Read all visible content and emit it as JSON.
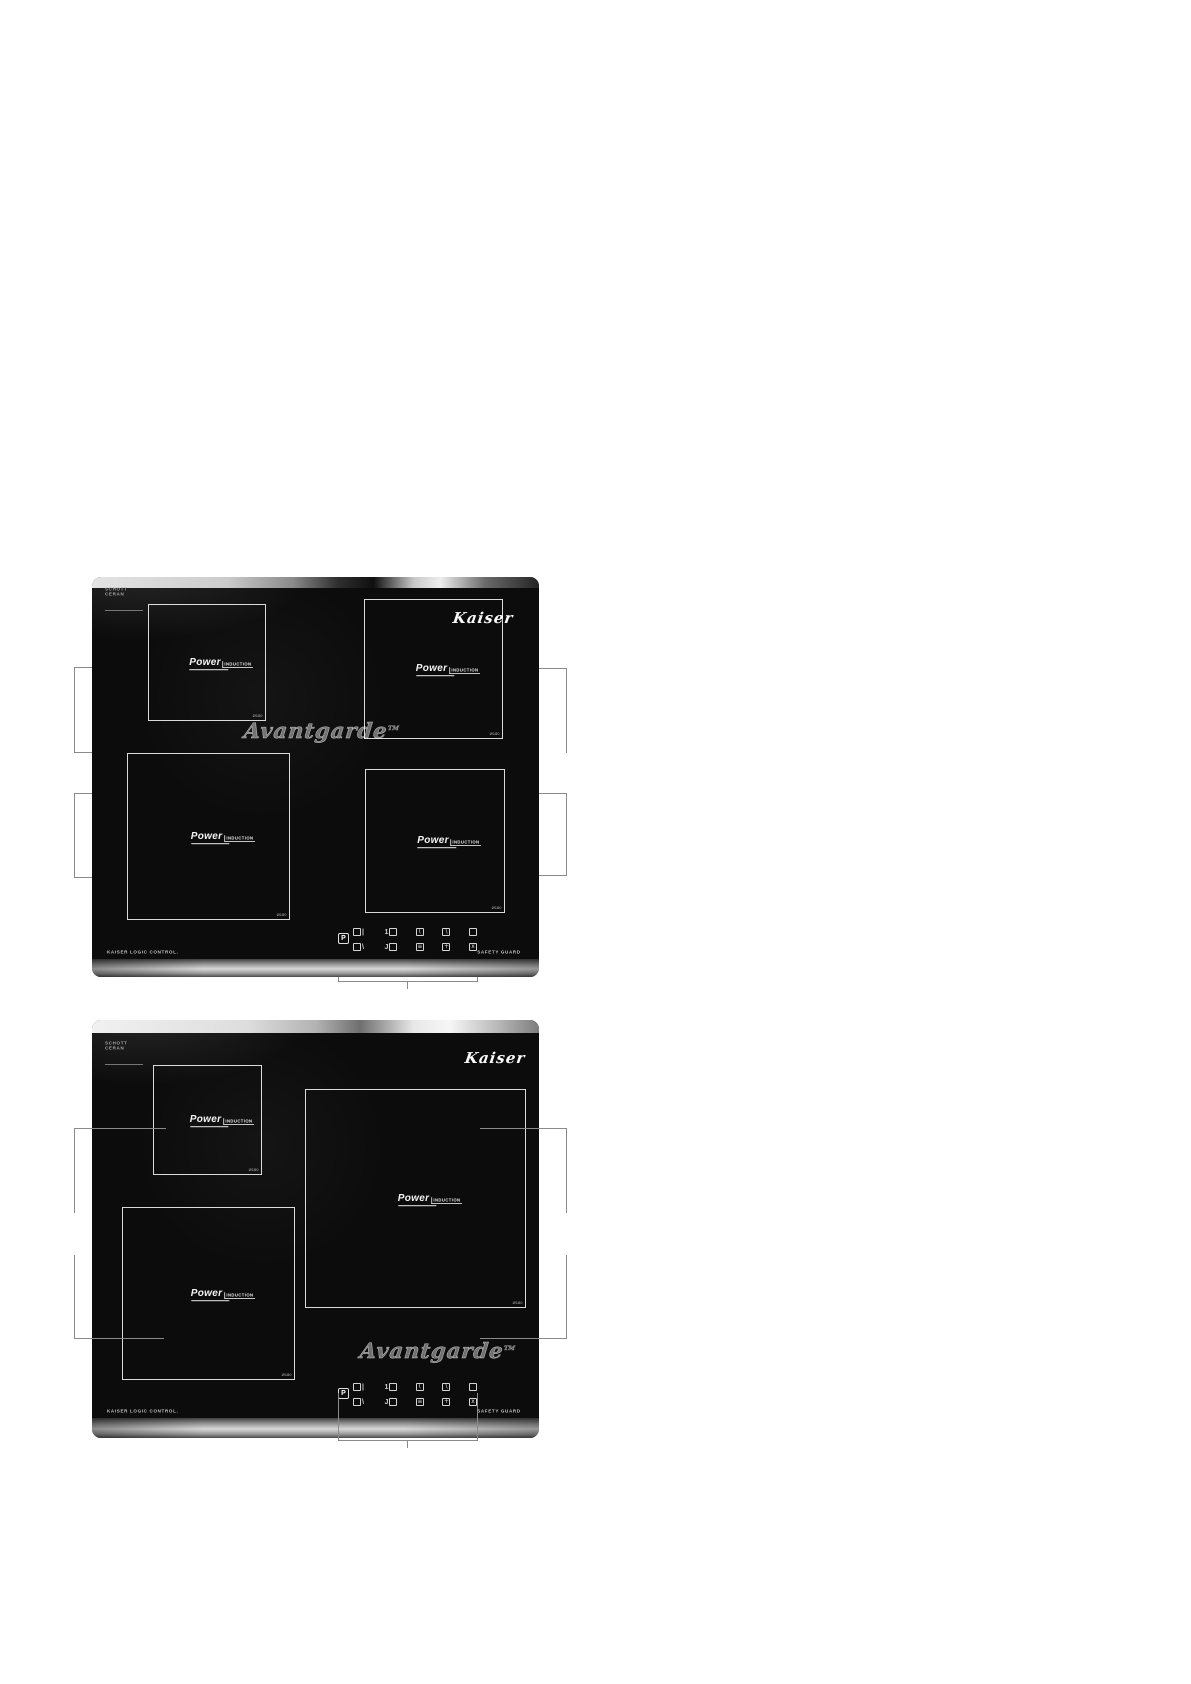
{
  "document": {
    "type": "appliance manual illustration page",
    "background": "#ffffff"
  },
  "shared": {
    "brand_logo": "Kaiser",
    "series_logo": "Avantgarde",
    "series_tm": "TM",
    "glass_mark": {
      "line1": "SCHOTT",
      "line2": "CERAN"
    },
    "power_logo": {
      "line1": "Power",
      "line2": "INDUCTION"
    },
    "bottom_left_label": "KAISER LOGIC CONTROL.",
    "bottom_right_label": "SAFETY GUARD",
    "controls": {
      "power_key": "P",
      "row1": [
        {
          "pre": "",
          "in": "",
          "suf": "|"
        },
        {
          "pre": "1",
          "in": "",
          "suf": ""
        },
        {
          "pre": "",
          "in": "(",
          "suf": ""
        },
        {
          "pre": "",
          "in": "\\",
          "suf": ""
        },
        {
          "pre": "",
          "in": "",
          "suf": ""
        }
      ],
      "row2": [
        {
          "pre": "",
          "in": "",
          "suf": "\\"
        },
        {
          "pre": "J",
          "in": "",
          "suf": ""
        },
        {
          "pre": "",
          "in": "≡",
          "suf": ""
        },
        {
          "pre": "",
          "in": "+",
          "suf": ""
        },
        {
          "pre": "",
          "in": "x",
          "suf": ""
        }
      ]
    }
  },
  "hob1": {
    "name": "four-zone induction hob",
    "zones": [
      {
        "position": "top-left",
        "size_label": "Ø180"
      },
      {
        "position": "top-right",
        "size_label": "Ø180"
      },
      {
        "position": "bottom-left",
        "size_label": "Ø180"
      },
      {
        "position": "bottom-right",
        "size_label": "Ø180"
      }
    ]
  },
  "hob2": {
    "name": "three-zone induction hob",
    "zones": [
      {
        "position": "top-left",
        "size_label": "Ø180"
      },
      {
        "position": "right-large",
        "size_label": "Ø180"
      },
      {
        "position": "bottom-left",
        "size_label": "Ø180"
      }
    ]
  },
  "colors": {
    "glass": "#0c0c0c",
    "trim_silver": "#b5b5b5",
    "zone_frame": "#ffffff",
    "callout_line": "#8a8a8a",
    "logo_text": "#fafafa"
  }
}
